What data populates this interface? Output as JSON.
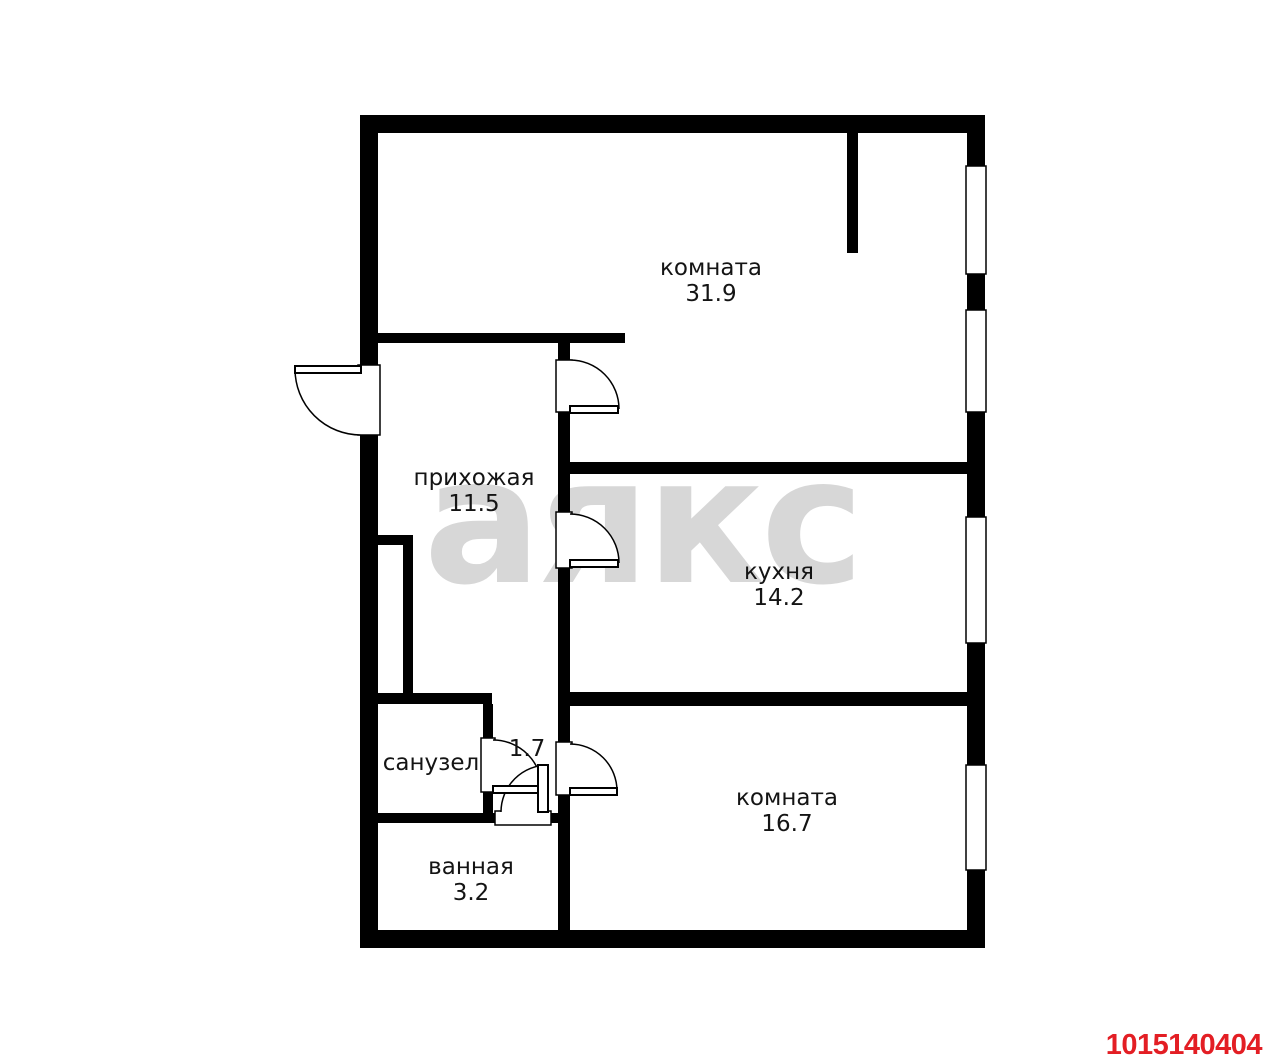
{
  "watermark": "аякс",
  "plan_id": "1015140404",
  "colors": {
    "wall": "#000000",
    "background": "#ffffff",
    "watermark": "#d7d7d7",
    "label": "#141414",
    "plan_id": "#e31e24",
    "outline": "#000000",
    "fill_white": "#ffffff"
  },
  "rooms": [
    {
      "name": "комната",
      "area": "31.9",
      "x": 711,
      "y": 267
    },
    {
      "name": "прихожая",
      "area": "11.5",
      "x": 474,
      "y": 477
    },
    {
      "name": "кухня",
      "area": "14.2",
      "x": 779,
      "y": 571
    },
    {
      "name": "санузел",
      "area": "",
      "x": 431,
      "y": 762
    },
    {
      "name": "",
      "area": "1.7",
      "x": 527,
      "y": 748
    },
    {
      "name": "комната",
      "area": "16.7",
      "x": 787,
      "y": 797
    },
    {
      "name": "ванная",
      "area": "3.2",
      "x": 471,
      "y": 866
    }
  ],
  "geometry": {
    "walls": [
      [
        360,
        115,
        625,
        18
      ],
      [
        360,
        115,
        18,
        833
      ],
      [
        967,
        115,
        18,
        833
      ],
      [
        360,
        930,
        625,
        18
      ],
      [
        847,
        133,
        11,
        120
      ],
      [
        378,
        333,
        247,
        10
      ],
      [
        558,
        333,
        12,
        597
      ],
      [
        568,
        462,
        399,
        12
      ],
      [
        558,
        692,
        409,
        14
      ],
      [
        378,
        535,
        35,
        10
      ],
      [
        403,
        545,
        10,
        148
      ],
      [
        378,
        693,
        114,
        11
      ],
      [
        483,
        704,
        10,
        109
      ],
      [
        378,
        813,
        180,
        10
      ]
    ],
    "windows": [
      [
        966,
        166,
        20,
        108
      ],
      [
        966,
        310,
        20,
        102
      ],
      [
        966,
        517,
        20,
        126
      ],
      [
        966,
        765,
        20,
        105
      ]
    ],
    "door_openings": [
      [
        358,
        365,
        22,
        70
      ],
      [
        556,
        360,
        16,
        52
      ],
      [
        556,
        512,
        16,
        56
      ],
      [
        556,
        742,
        16,
        53
      ],
      [
        481,
        738,
        14,
        54
      ],
      [
        495,
        811,
        56,
        14
      ]
    ],
    "door_leaves": [
      [
        295,
        366,
        66,
        7
      ],
      [
        570,
        406,
        48,
        7
      ],
      [
        570,
        560,
        48,
        7
      ],
      [
        570,
        788,
        47,
        7
      ],
      [
        493,
        786,
        49,
        7
      ],
      [
        538,
        765,
        10,
        47
      ]
    ],
    "door_arcs": [
      {
        "cx": 361,
        "cy": 369,
        "r": 66,
        "fx": 295,
        "fy": 369,
        "tx": 361,
        "ty": 435,
        "sweep": 0
      },
      {
        "cx": 570,
        "cy": 409,
        "r": 49,
        "fx": 570,
        "fy": 360,
        "tx": 619,
        "ty": 409,
        "sweep": 1
      },
      {
        "cx": 570,
        "cy": 563,
        "r": 49,
        "fx": 570,
        "fy": 514,
        "tx": 619,
        "ty": 563,
        "sweep": 1
      },
      {
        "cx": 570,
        "cy": 791,
        "r": 47,
        "fx": 570,
        "fy": 744,
        "tx": 617,
        "ty": 791,
        "sweep": 1
      },
      {
        "cx": 493,
        "cy": 789,
        "r": 49,
        "fx": 493,
        "fy": 740,
        "tx": 542,
        "ty": 789,
        "sweep": 1
      },
      {
        "cx": 548,
        "cy": 812,
        "r": 47,
        "fx": 501,
        "fy": 812,
        "tx": 548,
        "ty": 765,
        "sweep": 1
      }
    ]
  }
}
